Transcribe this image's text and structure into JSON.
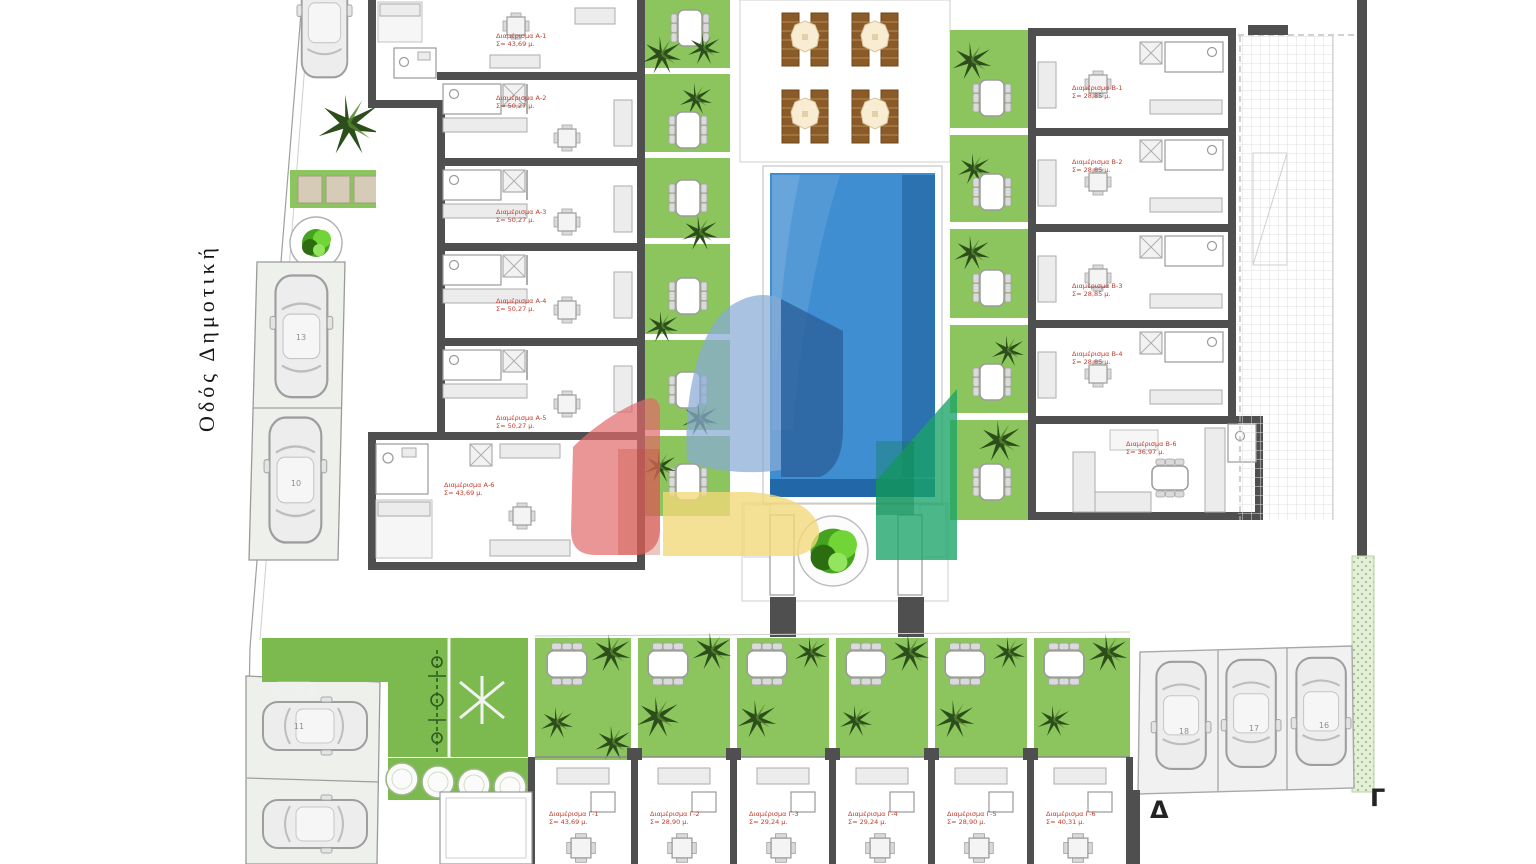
{
  "plan": {
    "street_label": "Οδός Δημοτική",
    "markers": {
      "delta": "Δ",
      "gamma": "Γ"
    }
  },
  "buildings": {
    "a": {
      "units": [
        {
          "label": "Διαμέρισμα Α-1",
          "area": "Σ= 43,69 μ."
        },
        {
          "label": "Διαμέρισμα Α-2",
          "area": "Σ= 50,27 μ."
        },
        {
          "label": "Διαμέρισμα Α-3",
          "area": "Σ= 50,27 μ."
        },
        {
          "label": "Διαμέρισμα Α-4",
          "area": "Σ= 50,27 μ."
        },
        {
          "label": "Διαμέρισμα Α-5",
          "area": "Σ= 50,27 μ."
        },
        {
          "label": "Διαμέρισμα Α-6",
          "area": "Σ= 43,69 μ."
        }
      ]
    },
    "b": {
      "units": [
        {
          "label": "Διαμέρισμα Β-1",
          "area": "Σ= 28,85 μ."
        },
        {
          "label": "Διαμέρισμα Β-2",
          "area": "Σ= 28,85 μ."
        },
        {
          "label": "Διαμέρισμα Β-3",
          "area": "Σ= 28,85 μ."
        },
        {
          "label": "Διαμέρισμα Β-4",
          "area": "Σ= 28,85 μ."
        },
        {
          "label": "Διαμέρισμα Β-6",
          "area": "Σ= 36,97 μ."
        }
      ]
    },
    "c": {
      "units": [
        {
          "label": "Διαμέρισμα Γ-1",
          "area": "Σ= 43,69 μ."
        },
        {
          "label": "Διαμέρισμα Γ-2",
          "area": "Σ= 28,90 μ."
        },
        {
          "label": "Διαμέρισμα Γ-3",
          "area": "Σ= 29,24 μ."
        },
        {
          "label": "Διαμέρισμα Γ-4",
          "area": "Σ= 29,24 μ."
        },
        {
          "label": "Διαμέρισμα Γ-5",
          "area": "Σ= 28,90 μ."
        },
        {
          "label": "Διαμέρισμα Γ-6",
          "area": "Σ= 40,31 μ."
        }
      ]
    }
  },
  "parking": {
    "street_column": [
      "13",
      "10"
    ],
    "bottom_left": [
      "11"
    ],
    "bottom_right": [
      "18",
      "17",
      "16"
    ]
  },
  "colors": {
    "lawn": "#7cb94e",
    "garden": "#8cc45d",
    "pool": "#3f8ed2",
    "pool_edge": "#2268a8",
    "wall": "#4f4f4f",
    "unit_label": "#c0392b",
    "logo_red": "#e26a6a",
    "logo_lightblue": "#88abd6",
    "logo_blue": "#2c619c",
    "logo_green": "#19a468",
    "logo_yellow": "#f2d978"
  }
}
